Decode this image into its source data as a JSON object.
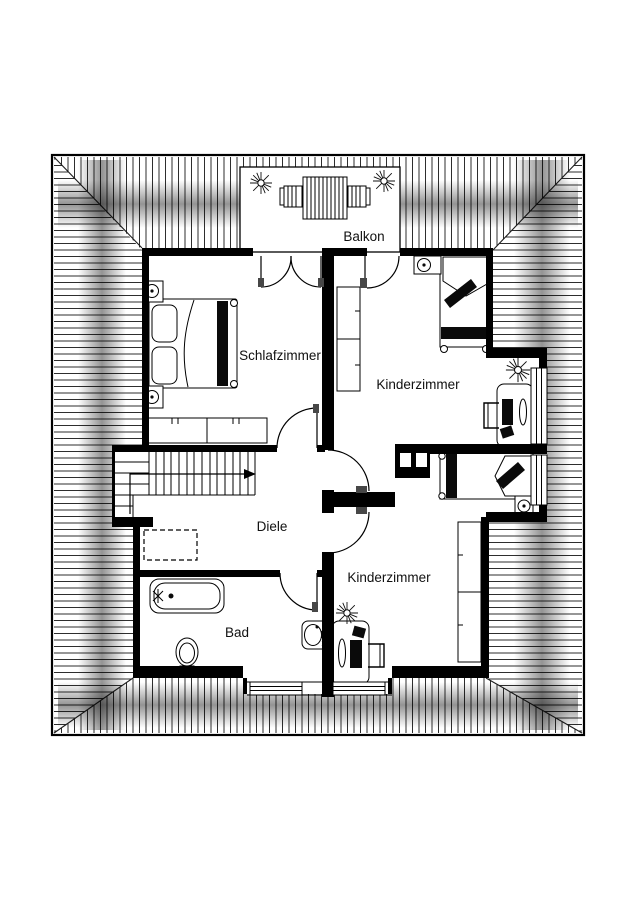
{
  "plan": {
    "type": "floor-plan",
    "floor": "attic",
    "rooms": [
      {
        "name": "balcony",
        "label": "Balkon"
      },
      {
        "name": "bedroom",
        "label": "Schlafzimmer"
      },
      {
        "name": "kids-room-top",
        "label": "Kinderzimmer"
      },
      {
        "name": "hallway",
        "label": "Diele"
      },
      {
        "name": "kids-room-bottom",
        "label": "Kinderzimmer"
      },
      {
        "name": "bathroom",
        "label": "Bad"
      }
    ],
    "colors": {
      "walls": "#000000",
      "hatch_lines": "#2e2e2e",
      "paper": "#ffffff",
      "eave_shadow": "#000000"
    },
    "depicted_elements": {
      "balcony": [
        "slatted-table",
        "chair",
        "chair",
        "plant",
        "plant",
        "double-door"
      ],
      "bedroom": [
        "double-bed",
        "two-pillows",
        "wardrobe",
        "radiator",
        "radiator",
        "door"
      ],
      "kids_room_top": [
        "single-bed",
        "shelf",
        "shelf",
        "desk",
        "desk-chair",
        "plant",
        "radiator",
        "balcony-door",
        "window"
      ],
      "kids_room_bottom": [
        "single-bed",
        "shelf",
        "shelf",
        "desk",
        "desk-chair",
        "plant",
        "radiator",
        "window",
        "window"
      ],
      "hallway": [
        "staircase",
        "direction-arrow",
        "dashed-opening"
      ],
      "bathroom": [
        "bathtub",
        "toilet",
        "washbasin",
        "door",
        "window"
      ],
      "structure": [
        "hip-roof-hatching",
        "eave-shadow",
        "chimney-with-two-flues",
        "load-bearing-center-wall"
      ]
    }
  }
}
